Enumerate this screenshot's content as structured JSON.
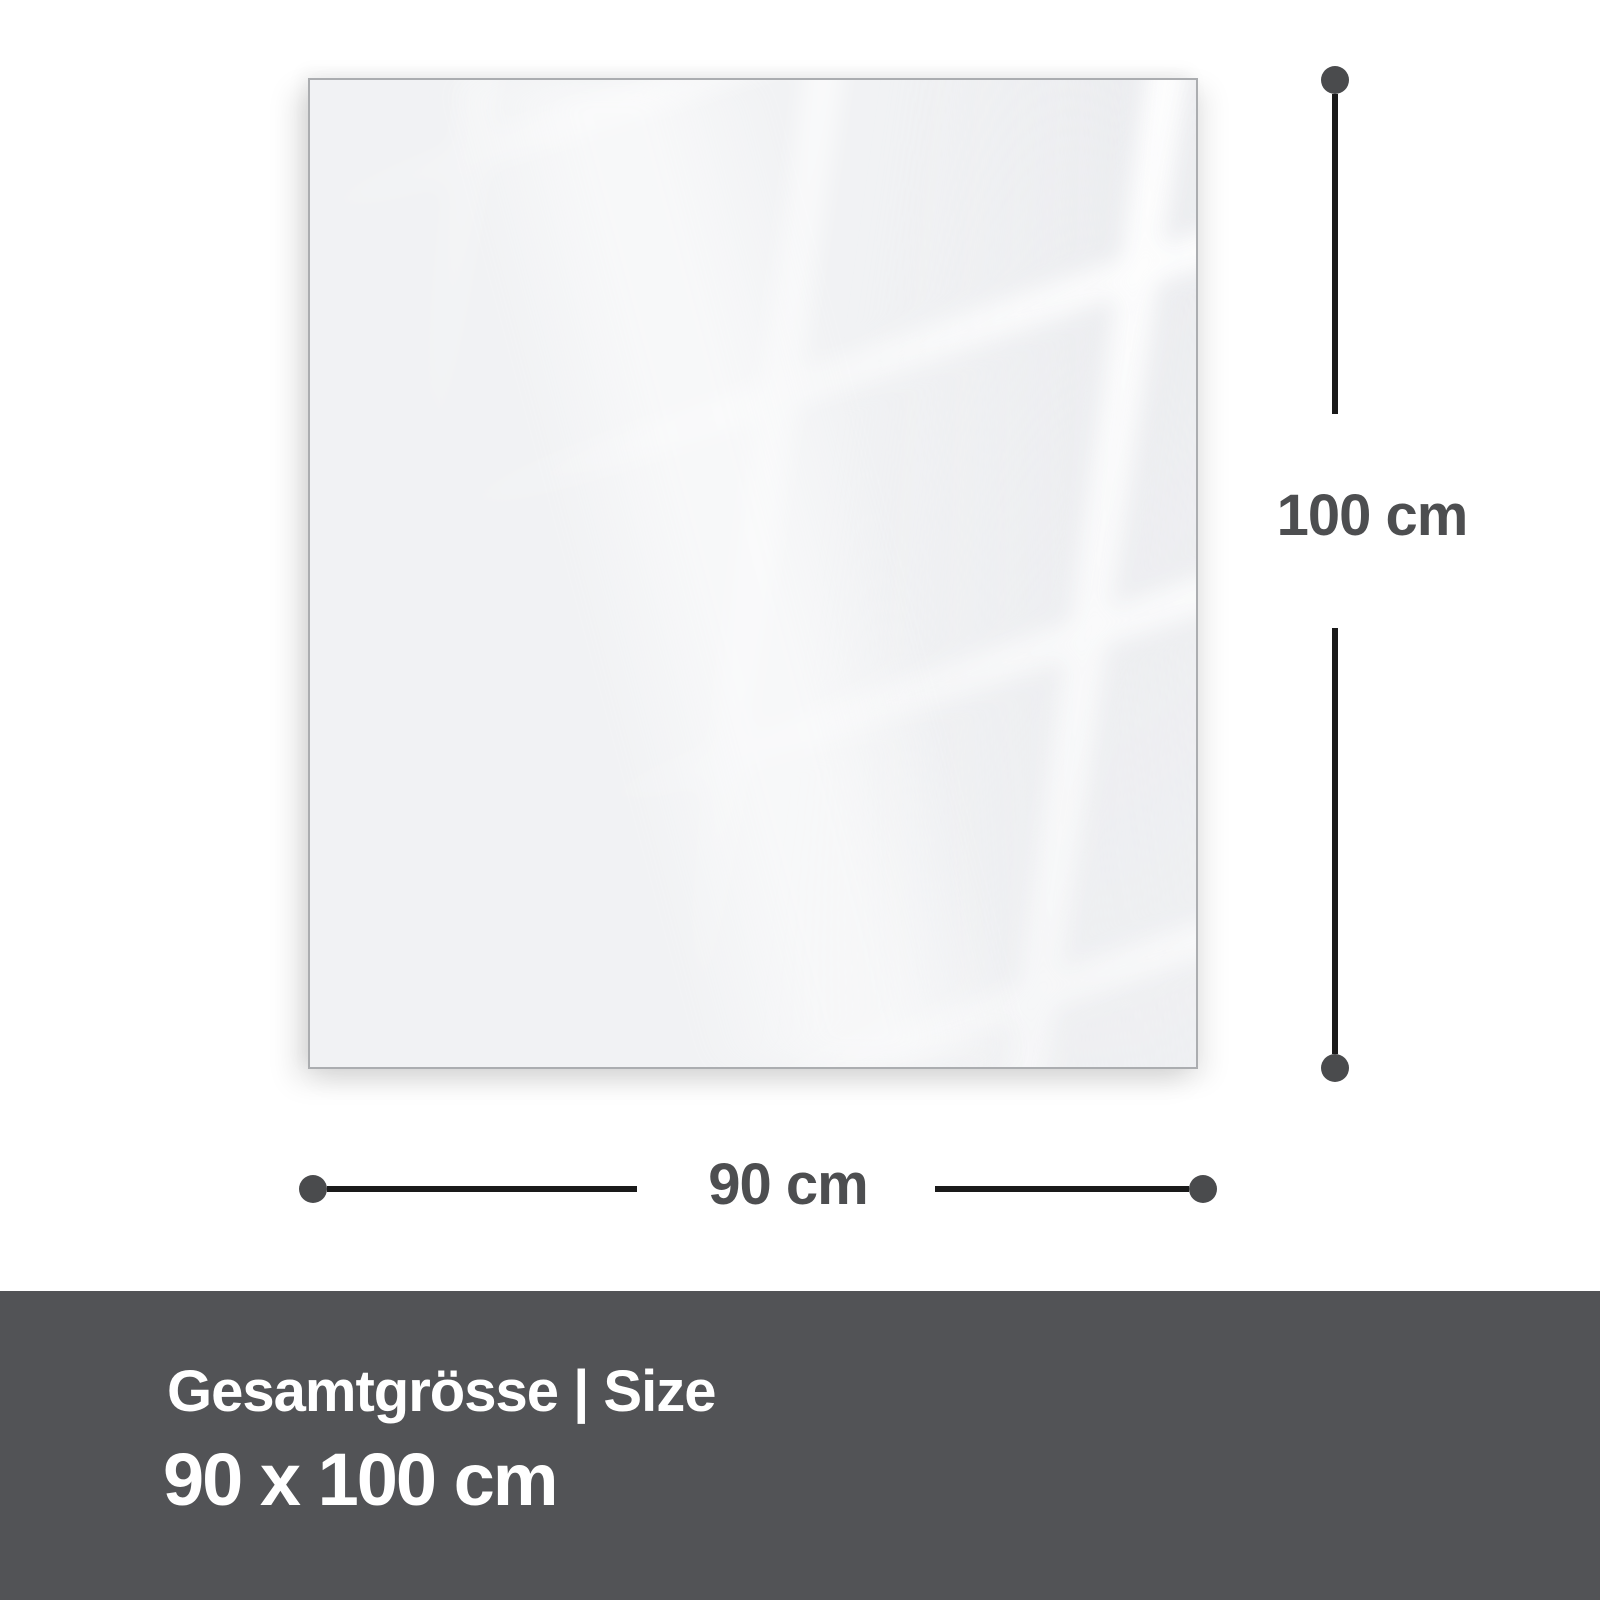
{
  "panel": {
    "description": "glass-panel-front-view"
  },
  "dimensions": {
    "height": {
      "label": "100 cm"
    },
    "width": {
      "label": "90 cm"
    }
  },
  "footer": {
    "title": "Gesamtgrösse | Size",
    "size_value": "90 x 100 cm"
  },
  "colors": {
    "panel-fill": "#f1f2f4",
    "panel-border": "#abadb0",
    "line": "#1a1a1a",
    "dot": "#4a4b4d",
    "label": "#4d4e50",
    "footer-bg": "#525356",
    "footer-text": "#ffffff"
  }
}
